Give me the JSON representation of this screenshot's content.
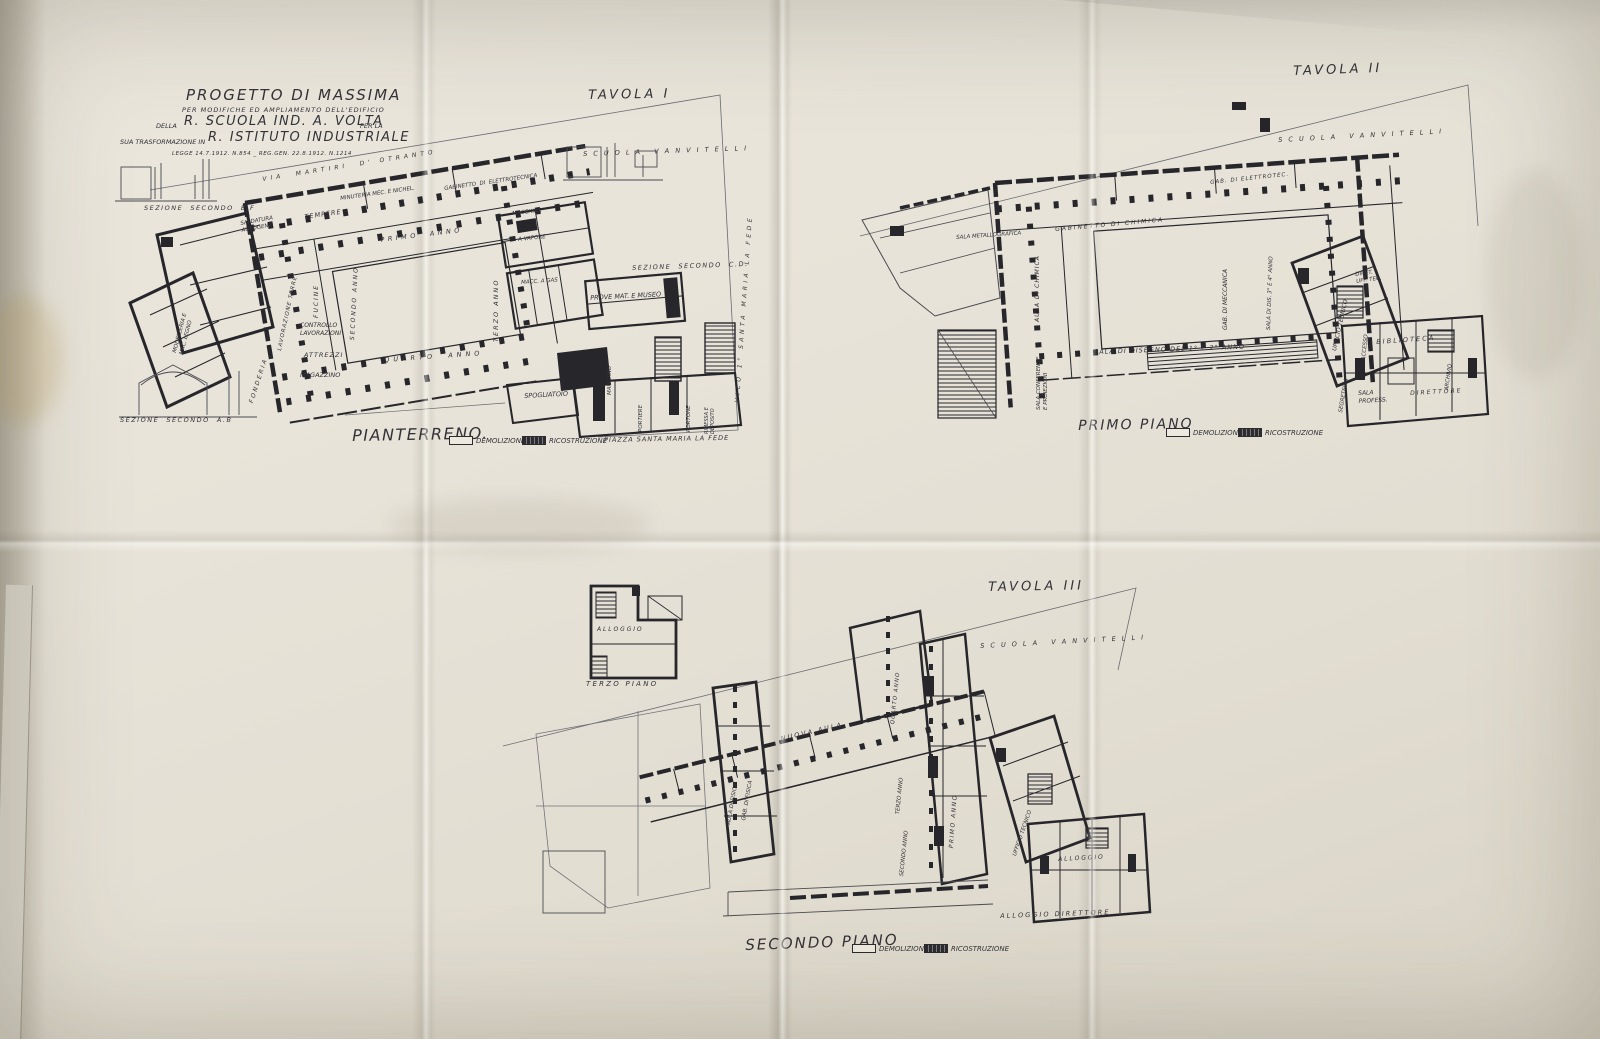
{
  "photo": {
    "paper_color": "#e9e5da",
    "ink_color": "#2b2b30"
  },
  "title_block": {
    "line1": "PROGETTO DI MASSIMA",
    "line2": "PER MODIFICHE ED AMPLIAMENTO DELL'EDIFICIO",
    "line3_small": "DELLA",
    "line3_big": "R. SCUOLA IND. A. VOLTA",
    "line3_tail": "PER LA",
    "line4_small": "SUA TRASFORMAZIONE IN",
    "line4_big": "R. ISTITUTO INDUSTRIALE",
    "line5": "LEGGE 14.7.1912. N.854 _ REG.GEN. 22.8.1912. N.1214"
  },
  "tavola1": {
    "title": "TAVOLA I",
    "plan_name": "PIANTERRENO.",
    "legend": {
      "demolizione": "DEMOLIZIONE",
      "ricostruzione": "RICOSTRUZIONE"
    },
    "labels": {
      "scuola": "S C U O L A   V A N V I T E L L I",
      "via_top": "VIA  MARTIRI  D' OTRANTO",
      "sezione_ef": "SEZIONE  SECONDO  E.F",
      "sezione_cd": "SEZIONE  SECONDO  C.D.",
      "sezione_ab": "SEZIONE  SECONDO  A.B",
      "saldatura": "SALDATURA\nAUTOGENA",
      "tempere": "TEMPERE",
      "minuteria": "MINUTERIA MEC. E NICHEL.",
      "gabinetto_elettrotecnica": "GABINETTO  DI  ELETTROTECNICA",
      "macchine": "MACCHINE",
      "a_vapore": "A VAPORE",
      "primo_anno": "PRIMO  ANNO",
      "secondo_anno": "SECONDO ANNO",
      "terzo_anno": "TERZO ANNO",
      "quarto_anno": "QUARTO  ANNO",
      "fucine": "FUCINE",
      "lavorazione_terre": "LAVORAZIONE TERRE",
      "controllo": "CONTROLLO\nLAVORAZIONI",
      "attrezzi": "ATTREZZI",
      "magazzino": "MAGAZZINO",
      "fonderia": "FONDERIA",
      "modelleria": "MODELLERIA E\nMAC. LEGNO",
      "macc_a_gas": "MACC. A GAS",
      "prove_museo": "PROVE MAT. E MUSEO",
      "spogliatoio": "SPOGLIATOIO",
      "mangano": "MANGANO",
      "portiere": "PORTIERE",
      "portone": "PORTONE",
      "rimessa": "RIMESSA E\nDEPOSITO",
      "piazza": "PIAZZA SANTA MARIA LA FEDE",
      "vico": "VICO 1° SANTA MARIA LA FEDE"
    }
  },
  "tavola2": {
    "title": "TAVOLA II",
    "plan_name": "PRIMO PIANO",
    "legend": {
      "demolizione": "DEMOLIZIONE",
      "ricostruzione": "RICOSTRUZIONE"
    },
    "labels": {
      "scuola": "S C U O L A   V A N V I T E L L I",
      "gab_elettrotec": "GAB. DI ELETTROTEC.",
      "gabinetto_chimica": "G A B I N E T T O   D I   C H I M I C A",
      "metallografica": "SALA METALLOGRAFICA",
      "aula_chimica": "AULA DI CHIMICA",
      "gab_meccanica": "GAB. DI MECCANICA",
      "sala_dis_34": "SALA DI DIS. 3° E 4° ANNO",
      "sala_disegno_12": "SALA DI DISEGNO DEL 1° E 2° ANNO",
      "conferenze": "SALA CONFERENZE\nE PROIEZIONI",
      "ufficio_tecnico": "UFFICIO TECNICO",
      "diret_uff_tec": "DIRET.\nUFF. TEC.",
      "accesso": "ACCESSO",
      "biblioteca": "B I B L I O T E C A",
      "segreteria": "SEGRETERIA",
      "sala_profess": "SALA\nPROFESS.",
      "direttore": "DIRETTORE",
      "archivio": "ARCHIVIO"
    }
  },
  "tavola3": {
    "title": "TAVOLA III",
    "plan_name": "SECONDO PIANO",
    "legend": {
      "demolizione": "DEMOLIZIONE",
      "ricostruzione": "RICOSTRUZIONE"
    },
    "labels": {
      "scuola": "S C U O L A   V A N V I T E L L I",
      "terzo_piano": "T E R Z O   P I A N O",
      "alloggio_small": "A L L O G G I O",
      "nuova_aula": "N U O V A   A U L A",
      "aula_fisica": "AULA DI FISICA",
      "gab_fisica": "GAB. DI FISICA",
      "quarto_anno": "QUARTO ANNO",
      "terzo_anno": "TERZO ANNO",
      "secondo_anno": "SECONDO ANNO",
      "primo_anno": "PRIMO ANNO",
      "ufficio_tecnico": "UFFICIO TECNICO",
      "alloggio": "A L L O G G I O",
      "alloggio_direttore": "A L L O G G I O   D I R E T T O R E",
      "secondo_piano_note": ""
    }
  }
}
